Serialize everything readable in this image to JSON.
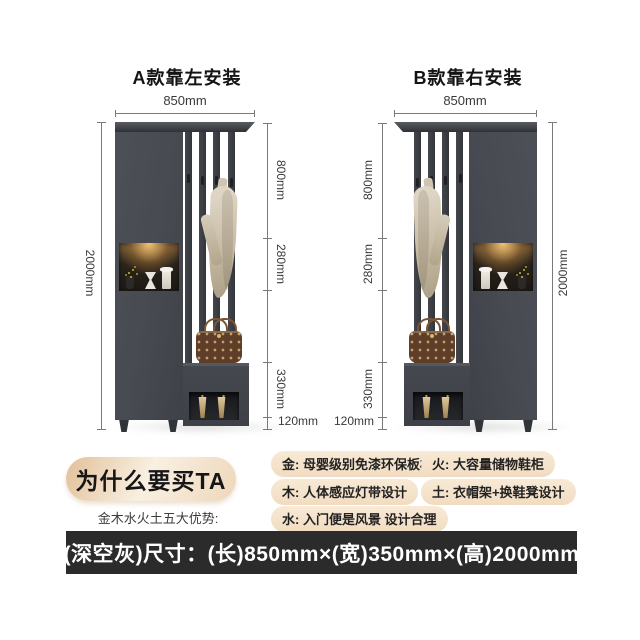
{
  "model_a": {
    "title": "A款靠左安装",
    "top_width": "850mm",
    "height": "2000mm",
    "seg_800": "800mm",
    "seg_280": "280mm",
    "seg_330": "330mm",
    "seg_120": "120mm"
  },
  "model_b": {
    "title": "B款靠右安装",
    "top_width": "850mm",
    "height": "2000mm",
    "seg_800": "800mm",
    "seg_280": "280mm",
    "seg_330": "330mm",
    "seg_120": "120mm"
  },
  "promo": {
    "badge": "为什么要买TA",
    "subtitle": "金木水火土五大优势:",
    "features": [
      "金: 母婴级别免漆环保板材",
      "木: 人体感应灯带设计",
      "水: 入门便是风景 设计合理",
      "火: 大容量储物鞋柜",
      "土: 衣帽架+换鞋凳设计"
    ]
  },
  "footer": {
    "size_text": "(深空灰)尺寸：(长)850mm×(宽)350mm×(高)2000mm"
  },
  "colors": {
    "cabinet_gray": "#46494f",
    "badge_beige": "#f0dcc2",
    "pill_beige": "#f5e2cb",
    "footer_bg": "#2b2b2b",
    "niche_glow": "#e8a54a",
    "dim_line": "#7a7a7a"
  }
}
